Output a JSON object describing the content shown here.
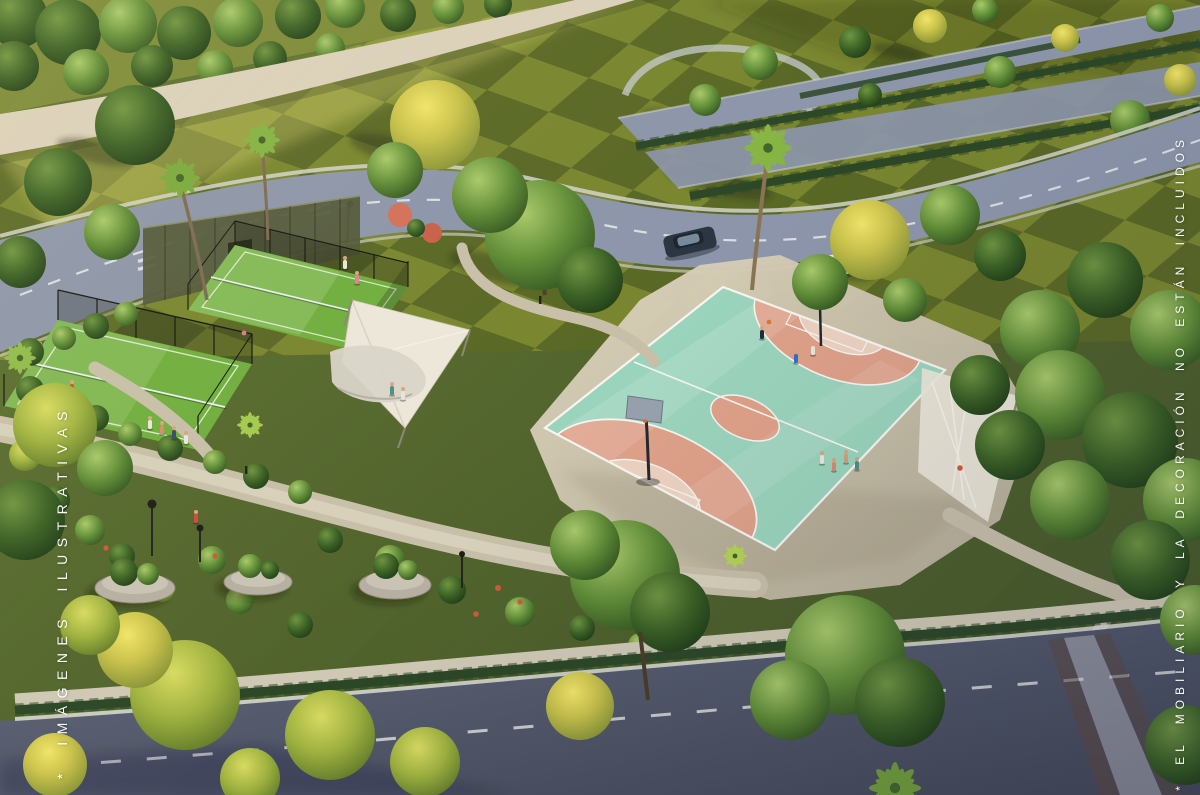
{
  "watermarks": {
    "left": "* IMÁGENES ILUSTRATIVAS",
    "right": "* EL MOBILIARIO Y LA DECORACIÓN NO ESTÁN INCLUIDOS"
  },
  "scene": {
    "colors": {
      "lawn_checker_light": "#79862f",
      "lawn_checker_dark": "#5a6826",
      "perimeter_wall": "#dbd1bc",
      "road_upper": "#8c95aa",
      "road_lower_start": "#60667a",
      "road_lower_end": "#424757",
      "walkway": "#c8bfa9",
      "sidewalk": "#cfc8b4",
      "hedge": "#2c4726",
      "padel_turf": "#6fae3e",
      "court_teal": "#9bd4bc",
      "court_salmon": "#dfa189",
      "court_key_light": "#ecd2c0",
      "court_line": "#f7f5ef",
      "canopy_white": "#ece7d9"
    }
  }
}
